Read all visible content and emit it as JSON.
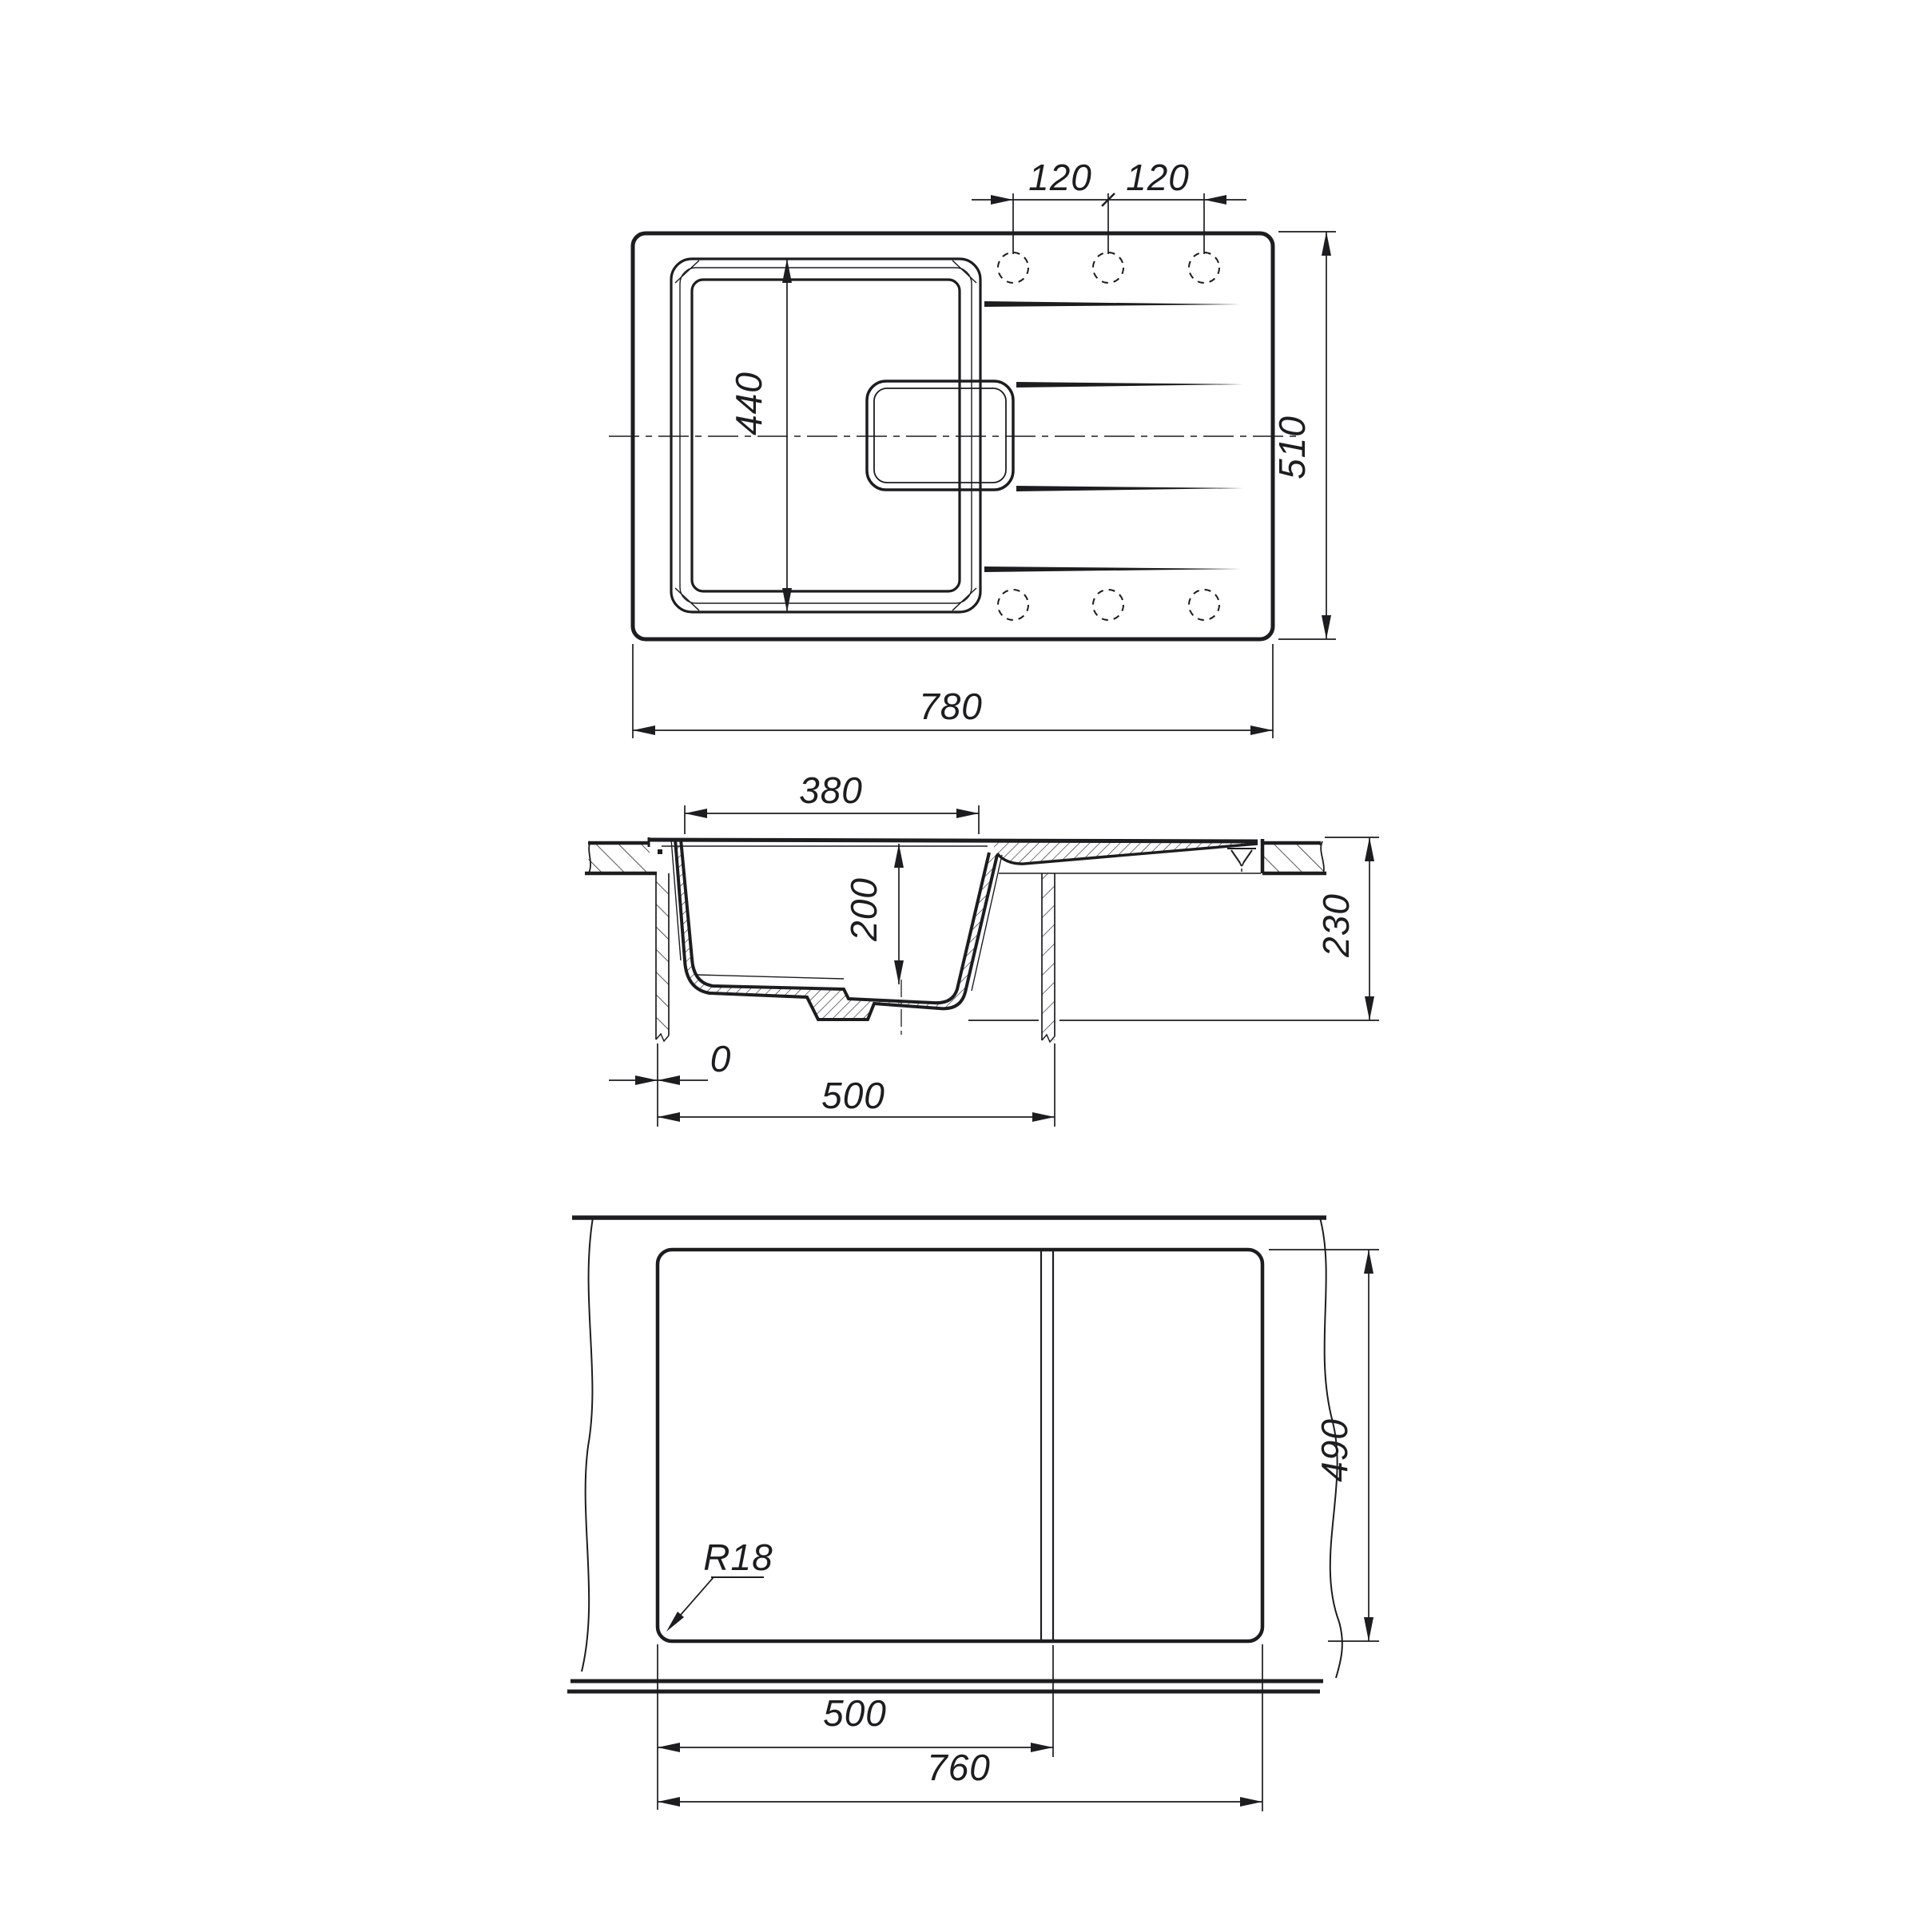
{
  "palette": {
    "ink": "#1d1d20",
    "paper": "#ffffff"
  },
  "plan_view": {
    "label_hole_pitch_left": "120",
    "label_hole_pitch_right": "120",
    "label_bowl_length": "440",
    "label_overall_depth": "510",
    "label_overall_width": "780"
  },
  "section_view": {
    "label_bowl_width": "380",
    "label_bowl_depth": "200",
    "label_overall_height": "230",
    "label_zero_offset": "0",
    "label_cabinet_width": "500"
  },
  "cutout_view": {
    "label_corner_radius": "R18",
    "label_cutout_depth": "490",
    "label_bowl_cutout_width": "500",
    "label_cutout_width": "760"
  }
}
